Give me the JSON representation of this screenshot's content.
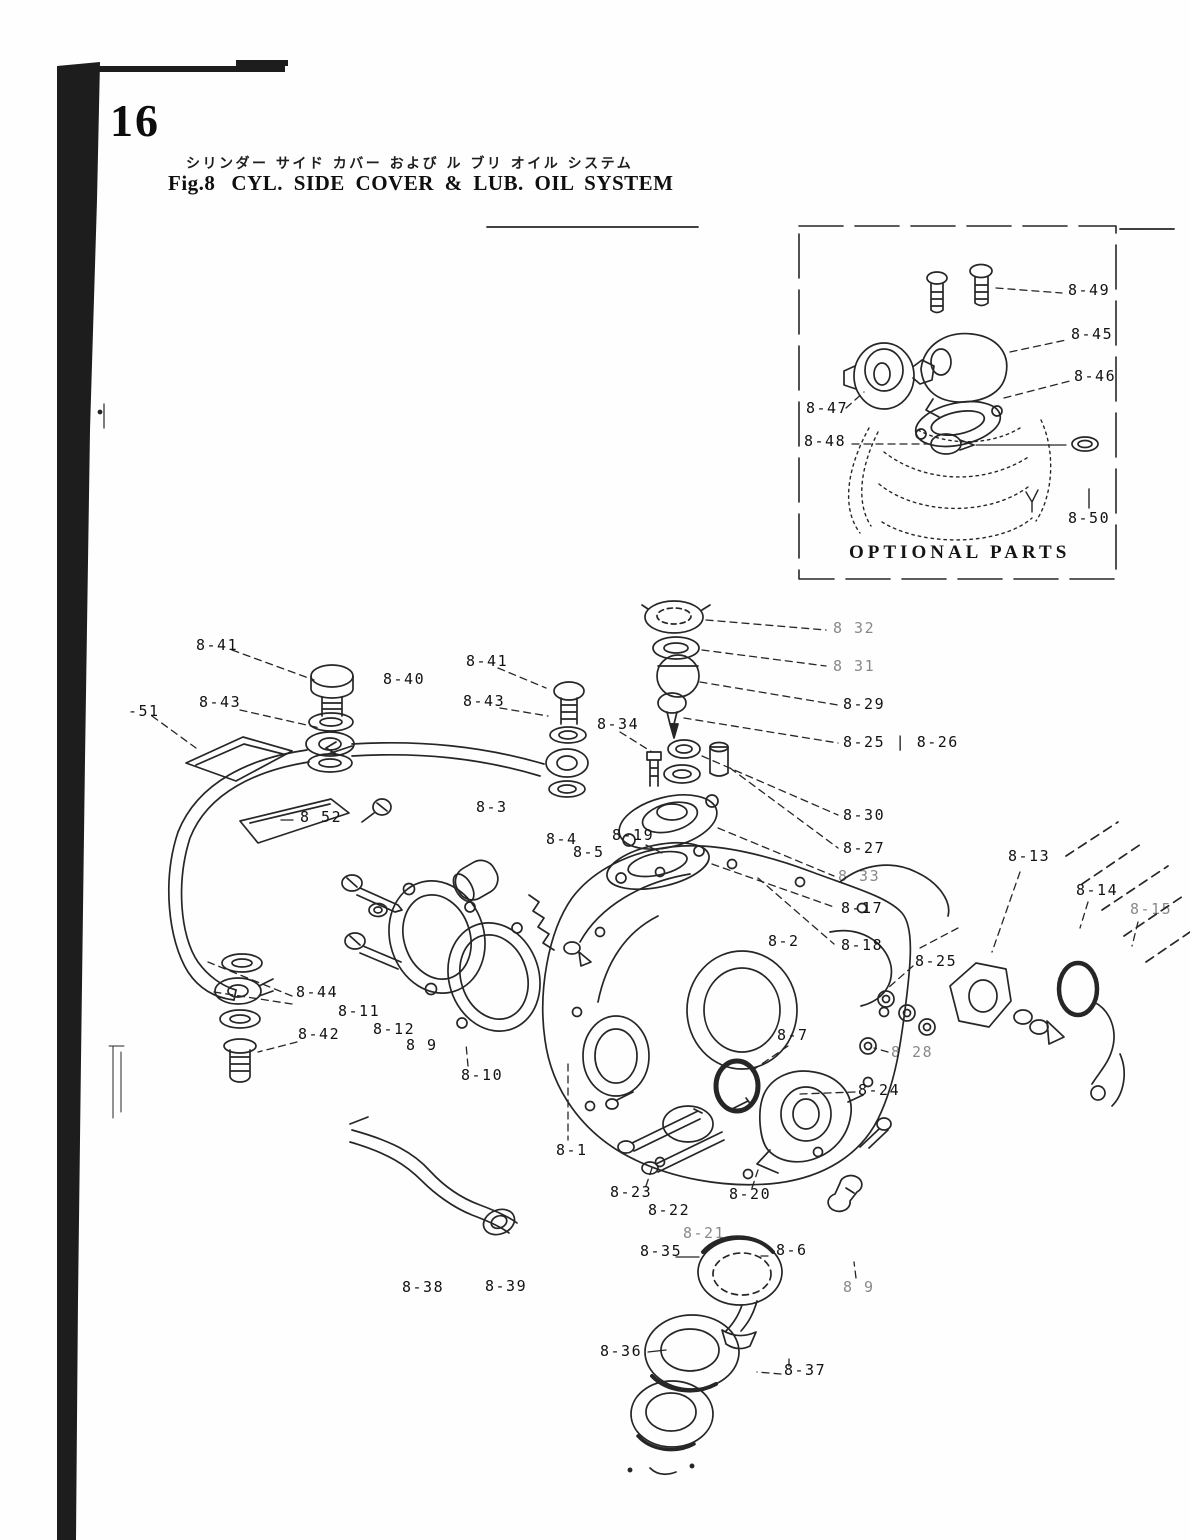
{
  "page": {
    "number": "16",
    "title_jp": "シリンダー サイド カバー および ル ブリ オイル システム",
    "figure_label": "Fig.8",
    "title_en": "CYL. SIDE COVER & LUB. OIL SYSTEM"
  },
  "optional_box": {
    "caption": "OPTIONAL PARTS",
    "labels": [
      {
        "text": "8-49",
        "x": 1068,
        "y": 283
      },
      {
        "text": "8-45",
        "x": 1071,
        "y": 327
      },
      {
        "text": "8-46",
        "x": 1074,
        "y": 369
      },
      {
        "text": "8-47",
        "x": 806,
        "y": 401
      },
      {
        "text": "8-48",
        "x": 804,
        "y": 434
      },
      {
        "text": "8-50",
        "x": 1068,
        "y": 511
      }
    ]
  },
  "diagram": {
    "labels": [
      {
        "text": "8-41",
        "x": 196,
        "y": 638
      },
      {
        "text": "8-40",
        "x": 383,
        "y": 672
      },
      {
        "text": "8-41",
        "x": 466,
        "y": 654
      },
      {
        "text": "8-43",
        "x": 199,
        "y": 695
      },
      {
        "text": "8-43",
        "x": 463,
        "y": 694
      },
      {
        "text": "-51",
        "x": 128,
        "y": 704
      },
      {
        "text": "8-34",
        "x": 597,
        "y": 717
      },
      {
        "text": "8 52",
        "x": 300,
        "y": 810
      },
      {
        "text": "8-3",
        "x": 476,
        "y": 800
      },
      {
        "text": "8 32",
        "x": 833,
        "y": 621,
        "dim": true
      },
      {
        "text": "8 31",
        "x": 833,
        "y": 659,
        "dim": true
      },
      {
        "text": "8-29",
        "x": 843,
        "y": 697
      },
      {
        "text": "8-25 | 8-26",
        "x": 843,
        "y": 735
      },
      {
        "text": "8-30",
        "x": 843,
        "y": 808
      },
      {
        "text": "8-27",
        "x": 843,
        "y": 841
      },
      {
        "text": "8 33",
        "x": 838,
        "y": 869,
        "dim": true
      },
      {
        "text": "8-17",
        "x": 841,
        "y": 901
      },
      {
        "text": "8-18",
        "x": 841,
        "y": 938
      },
      {
        "text": "8-4",
        "x": 546,
        "y": 832
      },
      {
        "text": "8-5",
        "x": 573,
        "y": 845
      },
      {
        "text": "8-19",
        "x": 612,
        "y": 828
      },
      {
        "text": "8-13",
        "x": 1008,
        "y": 849
      },
      {
        "text": "8-14",
        "x": 1076,
        "y": 883
      },
      {
        "text": "8-15",
        "x": 1130,
        "y": 902,
        "dim": true
      },
      {
        "text": "8-2",
        "x": 768,
        "y": 934
      },
      {
        "text": "8-25",
        "x": 915,
        "y": 954
      },
      {
        "text": "8-44",
        "x": 296,
        "y": 985
      },
      {
        "text": "8-11",
        "x": 338,
        "y": 1004
      },
      {
        "text": "8-42",
        "x": 298,
        "y": 1027
      },
      {
        "text": "8-12",
        "x": 373,
        "y": 1022
      },
      {
        "text": "8 9",
        "x": 406,
        "y": 1038
      },
      {
        "text": "8-7",
        "x": 777,
        "y": 1028
      },
      {
        "text": "8 28",
        "x": 891,
        "y": 1045,
        "dim": true
      },
      {
        "text": "8-10",
        "x": 461,
        "y": 1068
      },
      {
        "text": "8-24",
        "x": 858,
        "y": 1083
      },
      {
        "text": "8-1",
        "x": 556,
        "y": 1143
      },
      {
        "text": "8-23",
        "x": 610,
        "y": 1185
      },
      {
        "text": "8-20",
        "x": 729,
        "y": 1187
      },
      {
        "text": "8-22",
        "x": 648,
        "y": 1203
      },
      {
        "text": "8-21",
        "x": 683,
        "y": 1226,
        "dim": true
      },
      {
        "text": "8-35",
        "x": 640,
        "y": 1244
      },
      {
        "text": "8-6",
        "x": 776,
        "y": 1243
      },
      {
        "text": "8 9",
        "x": 843,
        "y": 1280,
        "dim": true
      },
      {
        "text": "8-38",
        "x": 402,
        "y": 1280
      },
      {
        "text": "8-39",
        "x": 485,
        "y": 1279
      },
      {
        "text": "8-36",
        "x": 600,
        "y": 1344
      },
      {
        "text": "8-37",
        "x": 784,
        "y": 1363
      }
    ]
  }
}
